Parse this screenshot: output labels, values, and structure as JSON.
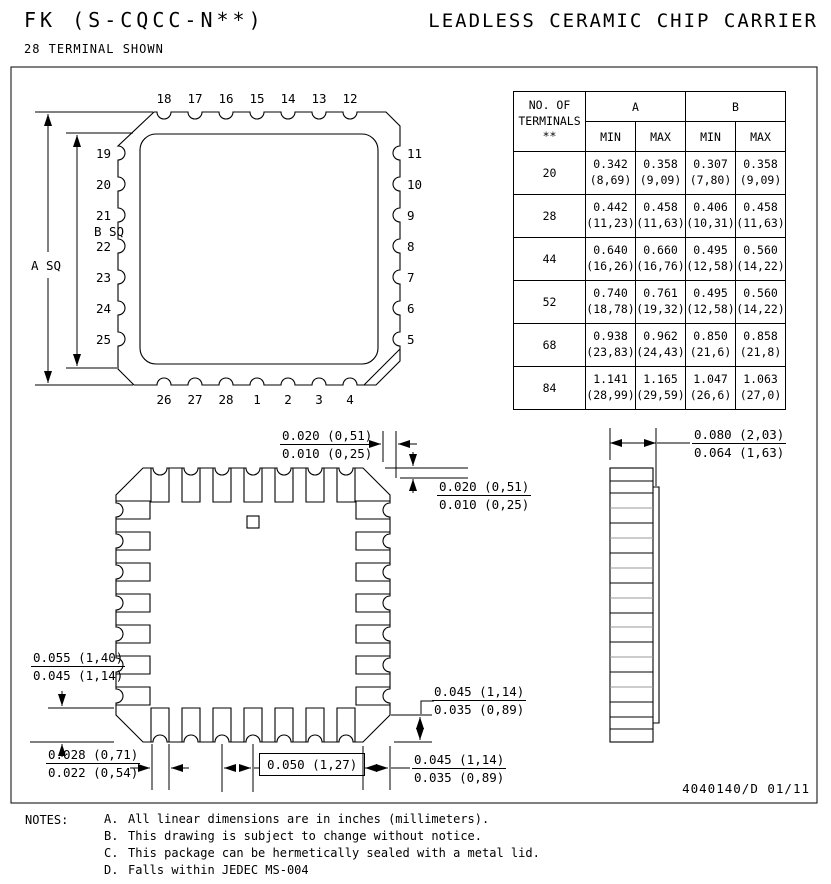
{
  "header": {
    "title_left": "FK (S-CQCC-N**)",
    "subtitle": "28 TERMINAL SHOWN",
    "title_right": "LEADLESS CERAMIC CHIP CARRIER"
  },
  "table": {
    "terminals_header_lines": [
      "NO. OF",
      "TERMINALS",
      "**"
    ],
    "group_a": "A",
    "group_b": "B",
    "subheaders": [
      "MIN",
      "MAX",
      "MIN",
      "MAX"
    ],
    "rows": [
      {
        "n": "20",
        "cells": [
          [
            "0.342",
            "(8,69)"
          ],
          [
            "0.358",
            "(9,09)"
          ],
          [
            "0.307",
            "(7,80)"
          ],
          [
            "0.358",
            "(9,09)"
          ]
        ]
      },
      {
        "n": "28",
        "cells": [
          [
            "0.442",
            "(11,23)"
          ],
          [
            "0.458",
            "(11,63)"
          ],
          [
            "0.406",
            "(10,31)"
          ],
          [
            "0.458",
            "(11,63)"
          ]
        ]
      },
      {
        "n": "44",
        "cells": [
          [
            "0.640",
            "(16,26)"
          ],
          [
            "0.660",
            "(16,76)"
          ],
          [
            "0.495",
            "(12,58)"
          ],
          [
            "0.560",
            "(14,22)"
          ]
        ]
      },
      {
        "n": "52",
        "cells": [
          [
            "0.740",
            "(18,78)"
          ],
          [
            "0.761",
            "(19,32)"
          ],
          [
            "0.495",
            "(12,58)"
          ],
          [
            "0.560",
            "(14,22)"
          ]
        ]
      },
      {
        "n": "68",
        "cells": [
          [
            "0.938",
            "(23,83)"
          ],
          [
            "0.962",
            "(24,43)"
          ],
          [
            "0.850",
            "(21,6)"
          ],
          [
            "0.858",
            "(21,8)"
          ]
        ]
      },
      {
        "n": "84",
        "cells": [
          [
            "1.141",
            "(28,99)"
          ],
          [
            "1.165",
            "(29,59)"
          ],
          [
            "1.047",
            "(26,6)"
          ],
          [
            "1.063",
            "(27,0)"
          ]
        ]
      }
    ]
  },
  "top_view": {
    "label_a": "A SQ",
    "label_b": "B SQ",
    "pins_top": [
      "18",
      "17",
      "16",
      "15",
      "14",
      "13",
      "12"
    ],
    "pins_left": [
      "19",
      "20",
      "21",
      "22",
      "23",
      "24",
      "25"
    ],
    "pins_right": [
      "11",
      "10",
      "9",
      "8",
      "7",
      "6",
      "5"
    ],
    "pins_bottom": [
      "26",
      "27",
      "28",
      "1",
      "2",
      "3",
      "4"
    ]
  },
  "dims": {
    "d_top_h": [
      "0.020 (0,51)",
      "0.010 (0,25)"
    ],
    "d_top_v": [
      "0.020 (0,51)",
      "0.010 (0,25)"
    ],
    "d_left": [
      "0.055 (1,40)",
      "0.045 (1,14)"
    ],
    "d_bl": [
      "0.028 (0,71)",
      "0.022 (0,54)"
    ],
    "d_pitch": "0.050 (1,27)",
    "d_br1": [
      "0.045 (1,14)",
      "0.035 (0,89)"
    ],
    "d_br2": [
      "0.045 (1,14)",
      "0.035 (0,89)"
    ],
    "d_side": [
      "0.080 (2,03)",
      "0.064 (1,63)"
    ]
  },
  "footer": {
    "doc": "4040140/D 01/11"
  },
  "notes": {
    "label": "NOTES:",
    "items": [
      {
        "id": "A.",
        "text": "All linear dimensions are in inches (millimeters)."
      },
      {
        "id": "B.",
        "text": "This drawing is subject to change without notice."
      },
      {
        "id": "C.",
        "text": "This package can be hermetically sealed with a metal lid."
      },
      {
        "id": "D.",
        "text": "Falls within JEDEC MS-004"
      }
    ]
  }
}
